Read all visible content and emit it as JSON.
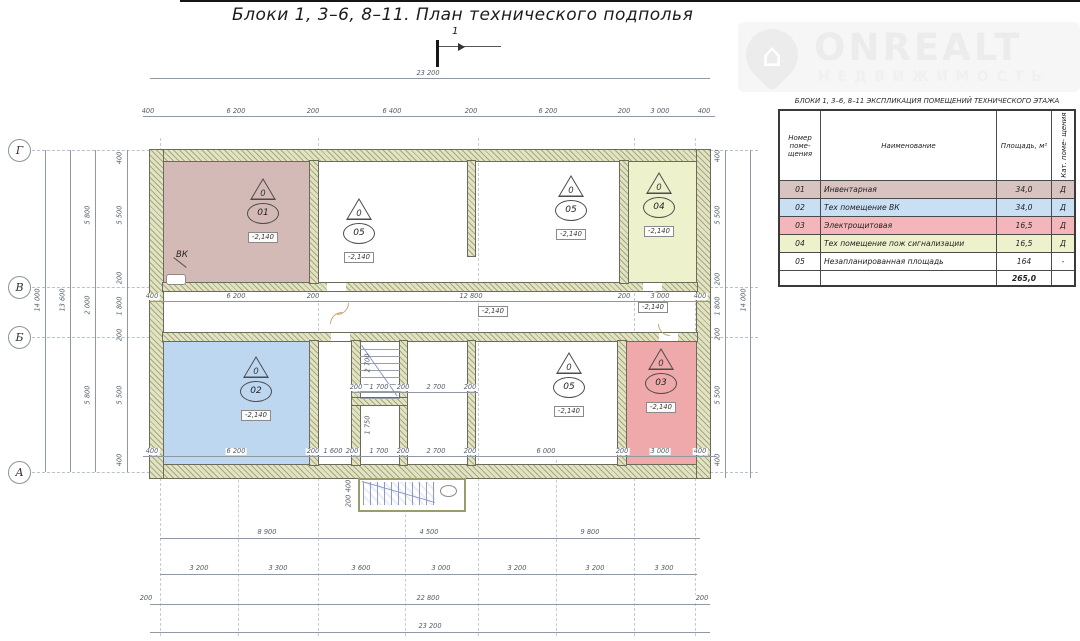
{
  "title": "Блоки 1,  3–6, 8–11.    План технического подполья",
  "section_marker": "1",
  "logo": {
    "brand": "ONREALT",
    "subtitle": "НЕДВИЖИМОСТЬ"
  },
  "legend": {
    "title": "БЛОКИ 1,  3–6, 8–11   ЭКСПЛИКАЦИЯ ПОМЕЩЕНИЙ ТЕХНИЧЕСКОГО ЭТАЖА",
    "headers": [
      "Номер поме- щения",
      "Наименование",
      "Площадь, м²",
      "Кат. поме- щения"
    ],
    "rows": [
      {
        "num": "01",
        "name": "Инвентарная",
        "area": "34,0",
        "cat": "Д",
        "color": "#d9c3c0"
      },
      {
        "num": "02",
        "name": "Тех помещение ВК",
        "area": "34,0",
        "cat": "Д",
        "color": "#c9dff4"
      },
      {
        "num": "03",
        "name": "Электрощитовая",
        "area": "16,5",
        "cat": "Д",
        "color": "#f4b6ba"
      },
      {
        "num": "04",
        "name": "Тех помещение пож сигнализации",
        "area": "16,5",
        "cat": "Д",
        "color": "#edf2cd"
      },
      {
        "num": "05",
        "name": "Незапланированная площадь",
        "area": "164",
        "cat": "-",
        "color": "#ffffff"
      }
    ],
    "total_area": "265,0"
  },
  "plan": {
    "axis_rows": [
      "Г",
      "В",
      "Б",
      "А"
    ],
    "zero": "0",
    "elevation": "-2,140",
    "vk_label": "ВК",
    "wall_color": "#e2e3c4",
    "hatch_color": "#8e905e",
    "rooms": [
      {
        "id": "01",
        "color": "#d4bab6"
      },
      {
        "id": "05",
        "color": "#ffffff"
      },
      {
        "id": "05",
        "color": "#ffffff"
      },
      {
        "id": "04",
        "color": "#edf2cc"
      },
      {
        "id": "02",
        "color": "#bdd7f1"
      },
      {
        "id": "05",
        "color": "#ffffff"
      },
      {
        "id": "03",
        "color": "#efa9ab"
      }
    ]
  },
  "dims": {
    "top_total": [
      "23 200"
    ],
    "top_row": [
      "400",
      "6 200",
      "200",
      "6 400",
      "200",
      "6 200",
      "200",
      "3 000",
      "400"
    ],
    "corridor_row": [
      "400",
      "6 200",
      "200",
      "12 800",
      "200",
      "3 000",
      "400"
    ],
    "bottom_inner_row": [
      "400",
      "6 200",
      "200",
      "1 600",
      "200",
      "1 700",
      "200",
      "2 700",
      "200",
      "6 000",
      "200",
      "3 000",
      "400"
    ],
    "stair_row": [
      "200",
      "1 700",
      "200",
      "2 700",
      "200"
    ],
    "stair_v": [
      "2 700",
      "1 750"
    ],
    "stair_out_v": [
      "400",
      "200"
    ],
    "bottom_row1": [
      "8 900",
      "4 500",
      "9 800"
    ],
    "bottom_row2": [
      "3 200",
      "3 300",
      "3 600",
      "3 000",
      "3 200",
      "3 200",
      "3 300"
    ],
    "bottom_row3": [
      "200",
      "22 800",
      "200"
    ],
    "bottom_total": [
      "23 200"
    ],
    "left_col1": [
      "14 000"
    ],
    "left_col2": [
      "13 600"
    ],
    "left_col3": [
      "5 800",
      "2 000",
      "5 800"
    ],
    "left_col4": [
      "400",
      "5 500",
      "200",
      "1 800",
      "200",
      "5 500",
      "400"
    ],
    "right_col1": [
      "400",
      "5 500",
      "200",
      "1 800",
      "200",
      "5 500",
      "400"
    ],
    "right_col2": [
      "14 000"
    ]
  }
}
